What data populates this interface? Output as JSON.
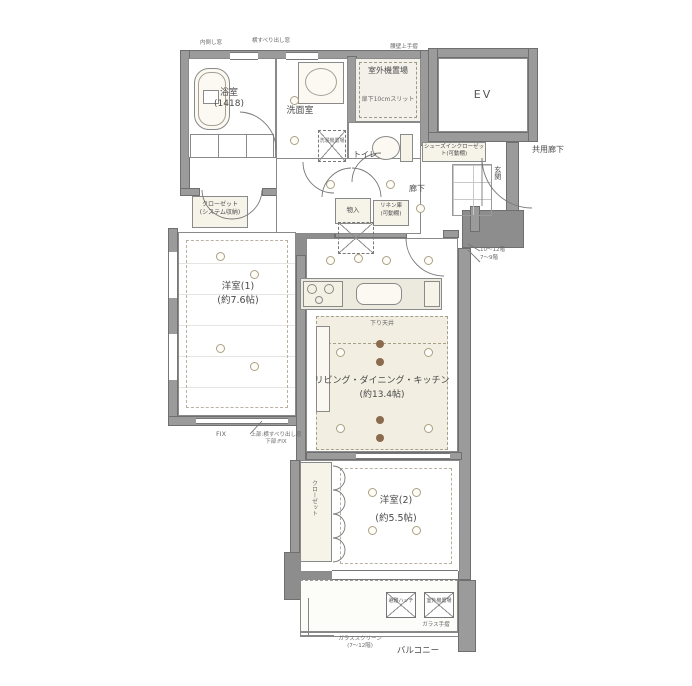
{
  "rooms": {
    "bathroom": {
      "name": "浴室",
      "size": "(1418)"
    },
    "washroom": {
      "name": "洗面室"
    },
    "outdoor_unit_top": {
      "name": "室外機置場",
      "note": "扉下10cmスリット"
    },
    "toilet": {
      "name": "トイレ"
    },
    "elevator": {
      "name": "EV"
    },
    "shared_corridor": {
      "name": "共用廊下"
    },
    "hallway": {
      "name": "廊下"
    },
    "entrance": {
      "name": "玄関"
    },
    "western_room_1": {
      "name": "洋室(1)",
      "size": "(約7.6帖)"
    },
    "ldk": {
      "name": "リビング・ダイニング・キッチン",
      "size": "(約13.4帖)"
    },
    "western_room_2": {
      "name": "洋室(2)",
      "size": "(約5.5帖)"
    },
    "balcony": {
      "name": "バルコニー"
    }
  },
  "storage": {
    "closet_1": {
      "name": "クローゼット",
      "sub": "(システム収納)"
    },
    "shoes_closet": {
      "name": "シューズインクローゼット(可動棚)"
    },
    "storage_hall": {
      "name": "物入"
    },
    "linen": {
      "name": "リネン庫",
      "sub": "(可動棚)"
    },
    "laundry": {
      "name": "洗濯機置場"
    },
    "closet_2": {
      "name": "クローゼット"
    }
  },
  "annotations": {
    "lowered_ceiling": "下り天井",
    "fix_window": "FIX",
    "window_note_upper": "上部:横すべり出し窓",
    "window_note_lower": "下部:FIX",
    "floors_upper": "10〜12階",
    "floors_lower": "7〜9階",
    "glass_screen": "ガラススクリーン",
    "glass_screen_floors": "(7〜12階)",
    "glass_rail": "ガラス手摺",
    "hatch": "避難ハッチ",
    "balcony_outdoor_unit": "室外機置場",
    "top_window_left": "内倒し窓",
    "top_window_center": "横すべり出し窓",
    "top_handrail": "腰壁上手摺"
  },
  "colors": {
    "wall": "#9b9b9b",
    "floor_beige": "#f2eee1",
    "downlight_dot": "#8b6b4e",
    "line": "#777777"
  }
}
